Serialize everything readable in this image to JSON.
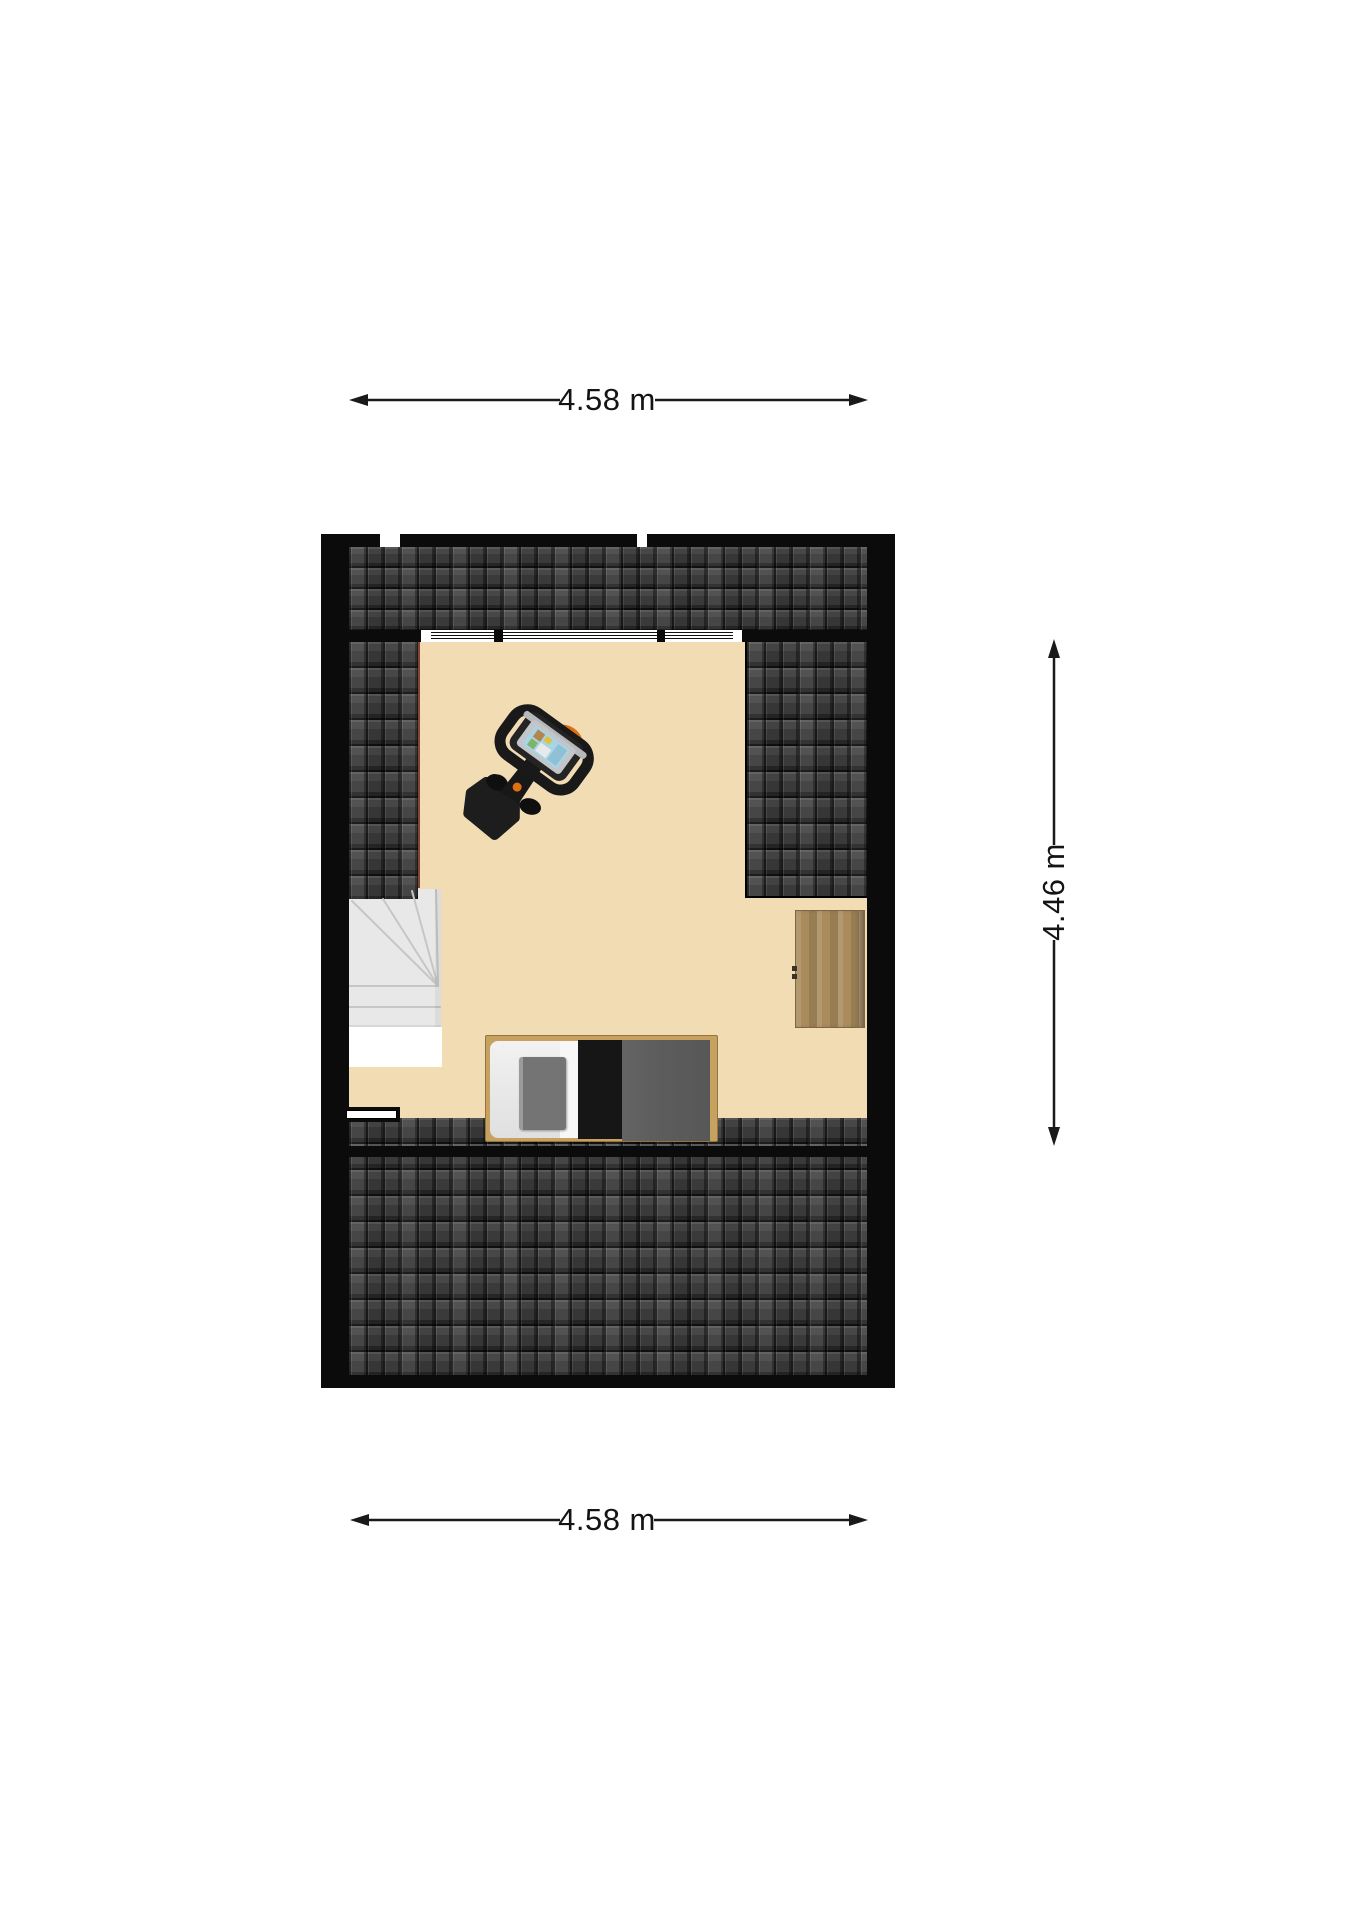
{
  "page": {
    "type": "floor-plan-screenshot",
    "background": "#ffffff"
  },
  "dimension_labels": {
    "top": "4.58 m",
    "bottom": "4.58 m",
    "right": "4.46 m"
  },
  "colors": {
    "floor": "#F2DCB4",
    "wall": "#0B0B0B",
    "tile-base": "#303030",
    "stairs": "#E8E8E8",
    "stairs-void": "#FFFFFF",
    "bed-frame": "#C7A160",
    "bed-mattress": "#ECECEC",
    "bed-pillow": "#747474",
    "bed-runner": "#161616",
    "bed-blanket": "#5D5D5D",
    "wardrobe-wood": "#A98B5C",
    "bike-body": "#1D1D1D",
    "bike-accent": "#DE7012",
    "bike-screen": "#A8D4E6",
    "window-frame": "#FFFFFF",
    "floor-edge": "#6E2A1C",
    "dim-text": "#141414"
  },
  "objects": [
    {
      "name": "roof-slope-top"
    },
    {
      "name": "roof-window-band",
      "sections": 3
    },
    {
      "name": "roof-slope-left"
    },
    {
      "name": "roof-slope-right"
    },
    {
      "name": "roof-slope-bottom"
    },
    {
      "name": "staircase"
    },
    {
      "name": "knee-wall-window"
    },
    {
      "name": "bed"
    },
    {
      "name": "wardrobe"
    },
    {
      "name": "exercise-bike"
    }
  ]
}
